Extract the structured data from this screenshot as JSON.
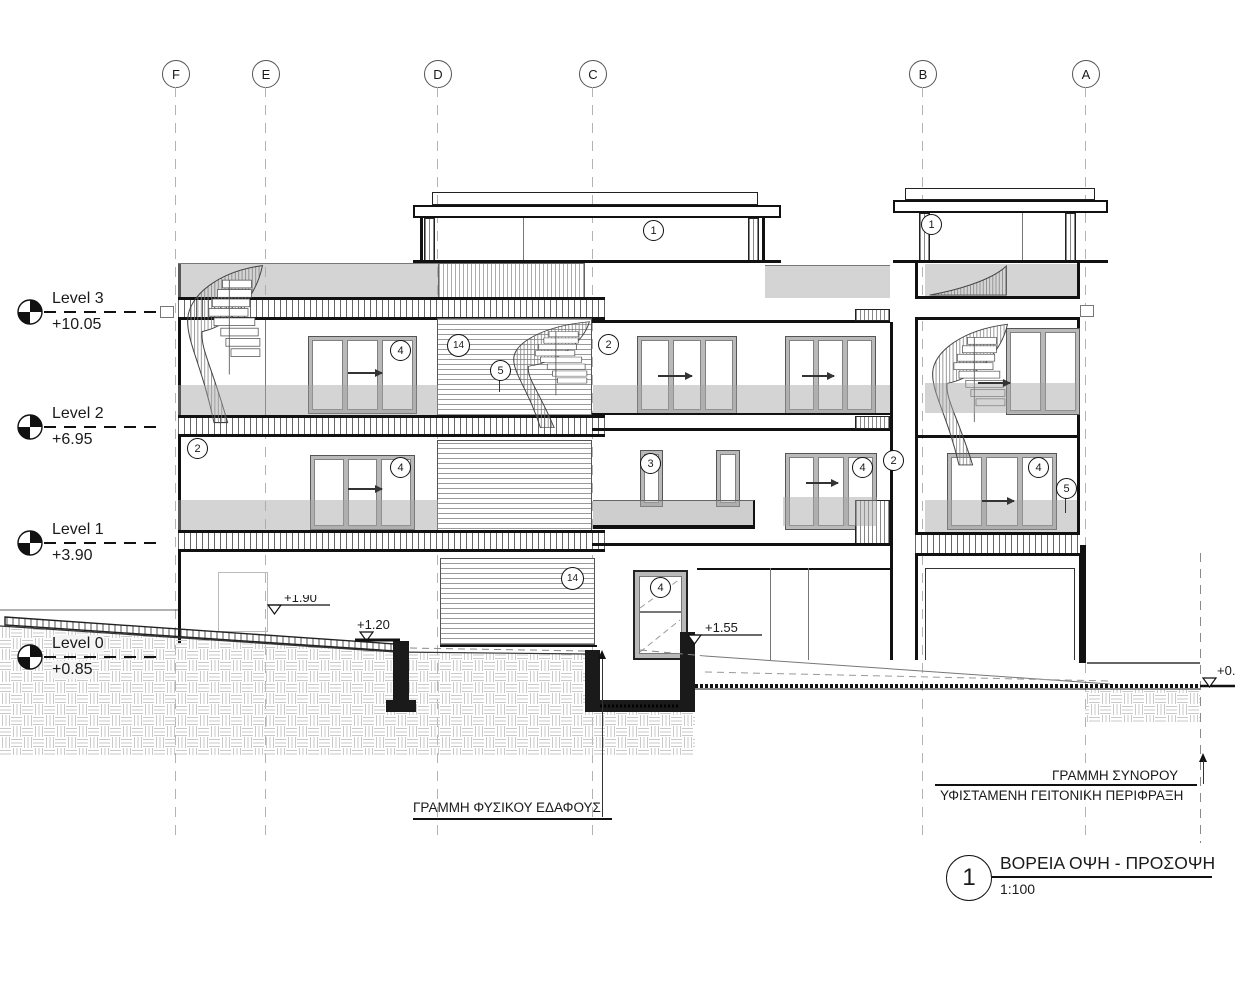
{
  "drawing": {
    "grid_labels": [
      "F",
      "E",
      "D",
      "C",
      "B",
      "A"
    ],
    "levels": [
      {
        "name": "Level 3",
        "elevation": "+10.05"
      },
      {
        "name": "Level 2",
        "elevation": "+6.95"
      },
      {
        "name": "Level 1",
        "elevation": "+3.90"
      },
      {
        "name": "Level 0",
        "elevation": "+0.85"
      }
    ],
    "spot_elevations": [
      "+1.90",
      "+1.20",
      "+1.55",
      "+0."
    ],
    "keynotes": [
      "1",
      "2",
      "3",
      "4",
      "5",
      "14"
    ],
    "annotations": {
      "natural_ground": "ΓΡΑΜΜΗ ΦΥΣΙΚΟΥ ΕΔΑΦΟΥΣ",
      "boundary": "ΓΡΑΜΜΗ ΣΥΝΟΡΟΥ",
      "fence": "ΥΦΙΣΤΑΜΕΝΗ ΓΕΙΤΟΝΙΚΗ ΠΕΡΙΦΡΑΞΗ"
    },
    "title": {
      "number": "1",
      "name": "ΒΟΡΕΙΑ ΟΨΗ - ΠΡΟΣΟΨΗ",
      "scale": "1:100"
    }
  }
}
